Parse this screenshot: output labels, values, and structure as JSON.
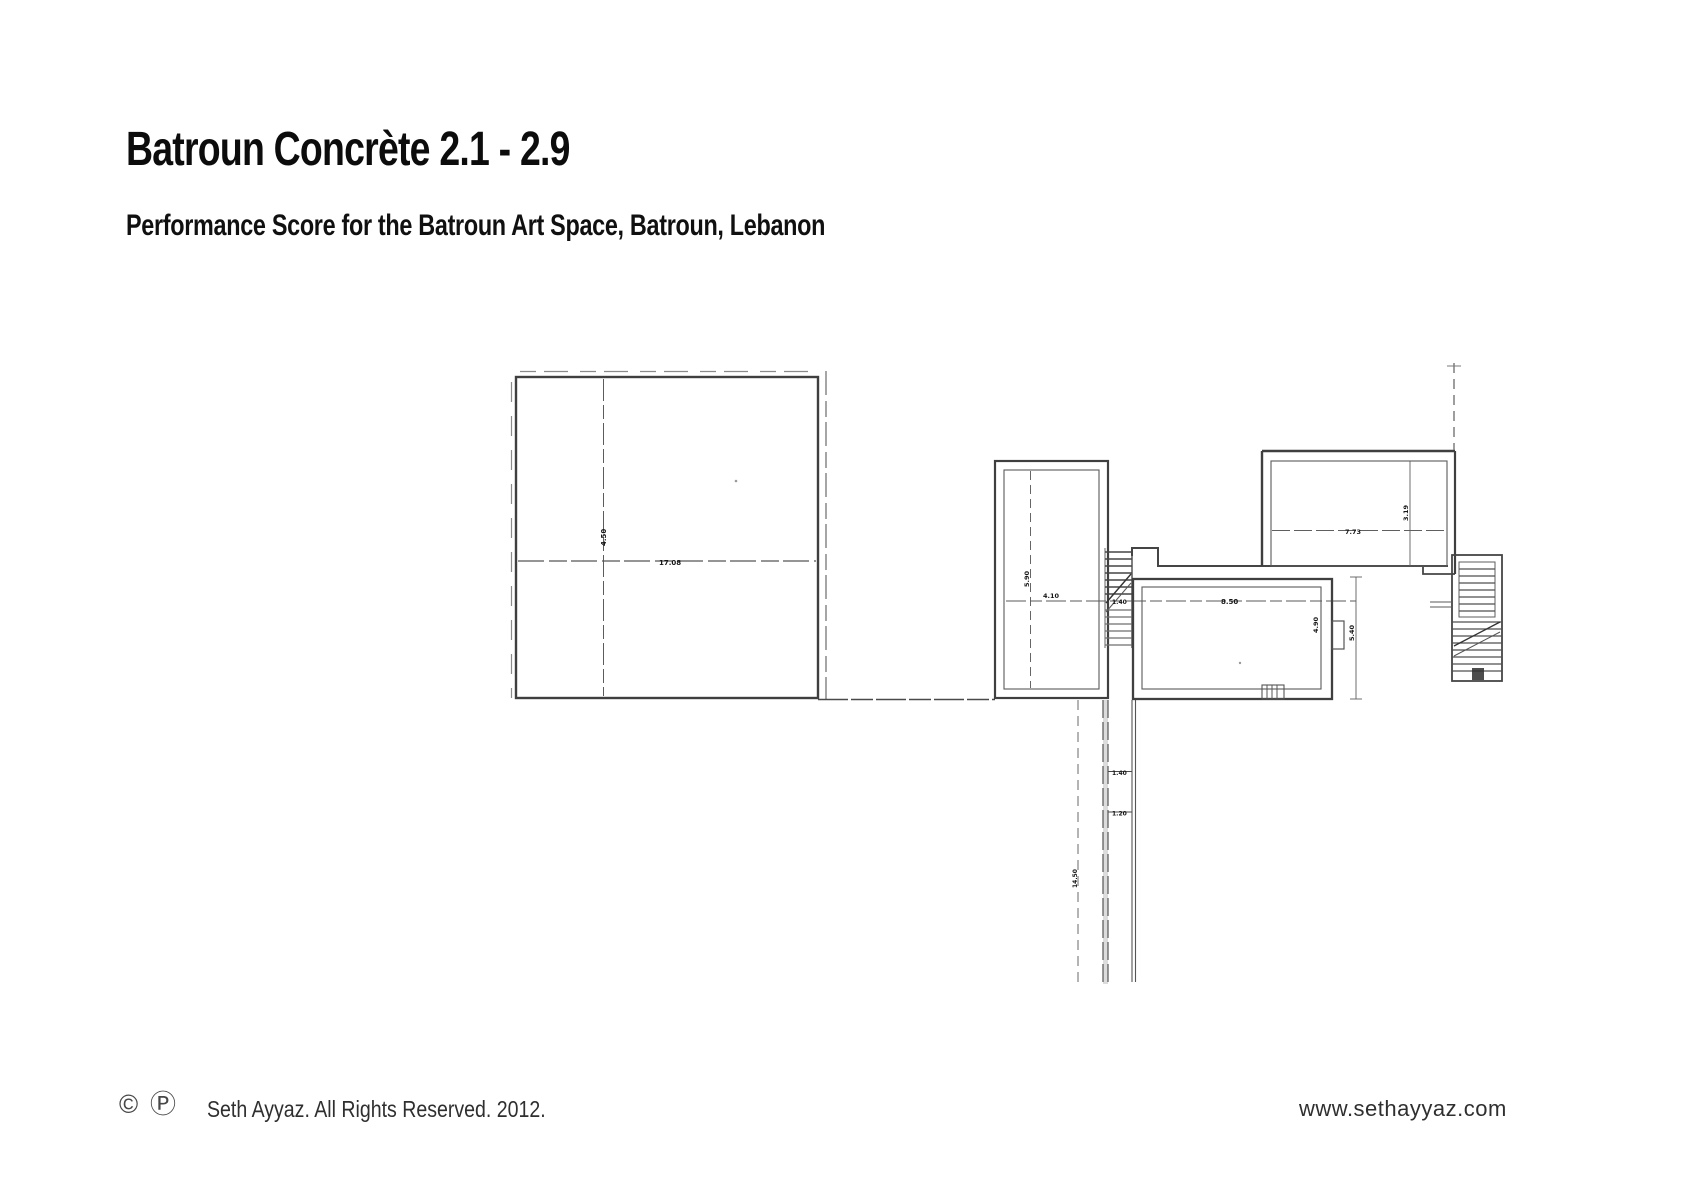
{
  "page": {
    "title": "Batroun Concrète 2.1 - 2.9",
    "subtitle": "Performance Score for the Batroun Art Space, Batroun, Lebanon"
  },
  "footer": {
    "copyright_symbol": "©",
    "phonogram_symbol": "Ⓟ",
    "rights_text": "Seth Ayyaz. All Rights Reserved. 2012.",
    "website": "www.sethayyaz.com"
  },
  "floorplan": {
    "dims": [
      {
        "id": "large-hall-height",
        "text": "4.50"
      },
      {
        "id": "large-hall-width",
        "text": "17.08"
      },
      {
        "id": "mid-room-height",
        "text": "5.90"
      },
      {
        "id": "mid-room-width",
        "text": "4.10"
      },
      {
        "id": "stair-hatch-width",
        "text": "1.40"
      },
      {
        "id": "lower-room-width",
        "text": "8.50"
      },
      {
        "id": "lower-room-height",
        "text": "4.90"
      },
      {
        "id": "right-dim",
        "text": "5.40"
      },
      {
        "id": "upper-room-width",
        "text": "7.73"
      },
      {
        "id": "upper-room-height",
        "text": "3.19"
      },
      {
        "id": "corridor-tick-1",
        "text": "1.40"
      },
      {
        "id": "corridor-tick-2",
        "text": "1.20"
      },
      {
        "id": "corridor-length",
        "text": "14.50"
      }
    ]
  }
}
